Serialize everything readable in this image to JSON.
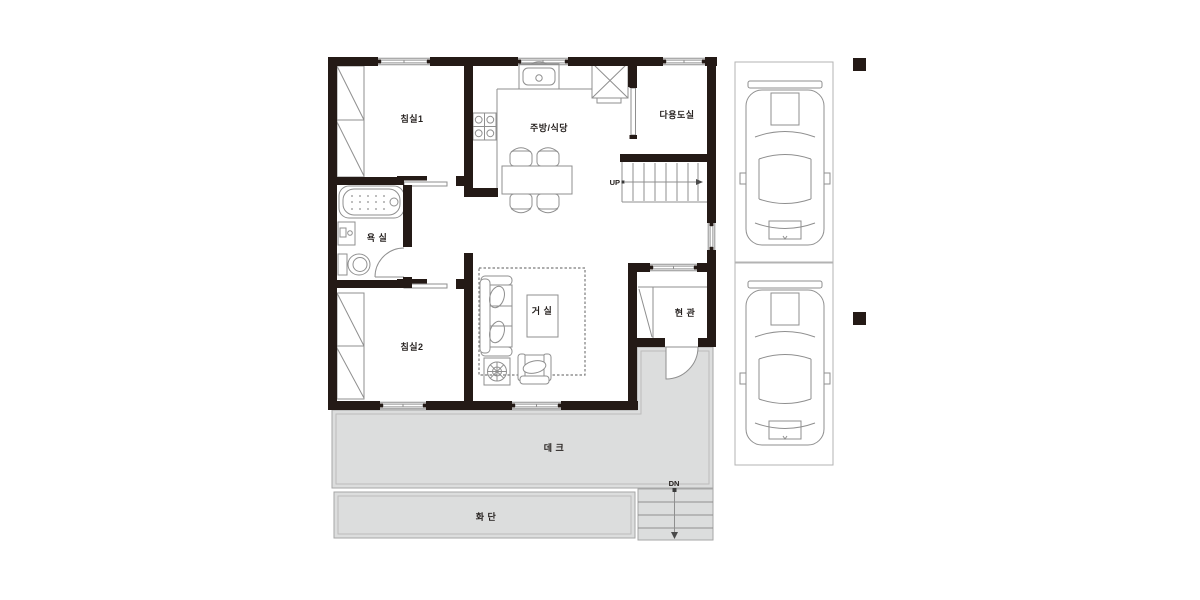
{
  "plan_labels": {
    "bedroom1": "침실1",
    "kitchen_dining": "주방/식당",
    "utility_room": "다용도실",
    "bathroom": "욕 실",
    "bedroom2": "침실2",
    "living_room": "거 실",
    "entrance": "현 관",
    "deck": "데 크",
    "flower_bed": "화 단",
    "stairs_up": "UP",
    "stairs_down": "DN"
  },
  "colors": {
    "wall": "#241a16",
    "thin_line": "#8f8f8f",
    "area_fill": "#dcdddd",
    "text": "#241f1d"
  }
}
